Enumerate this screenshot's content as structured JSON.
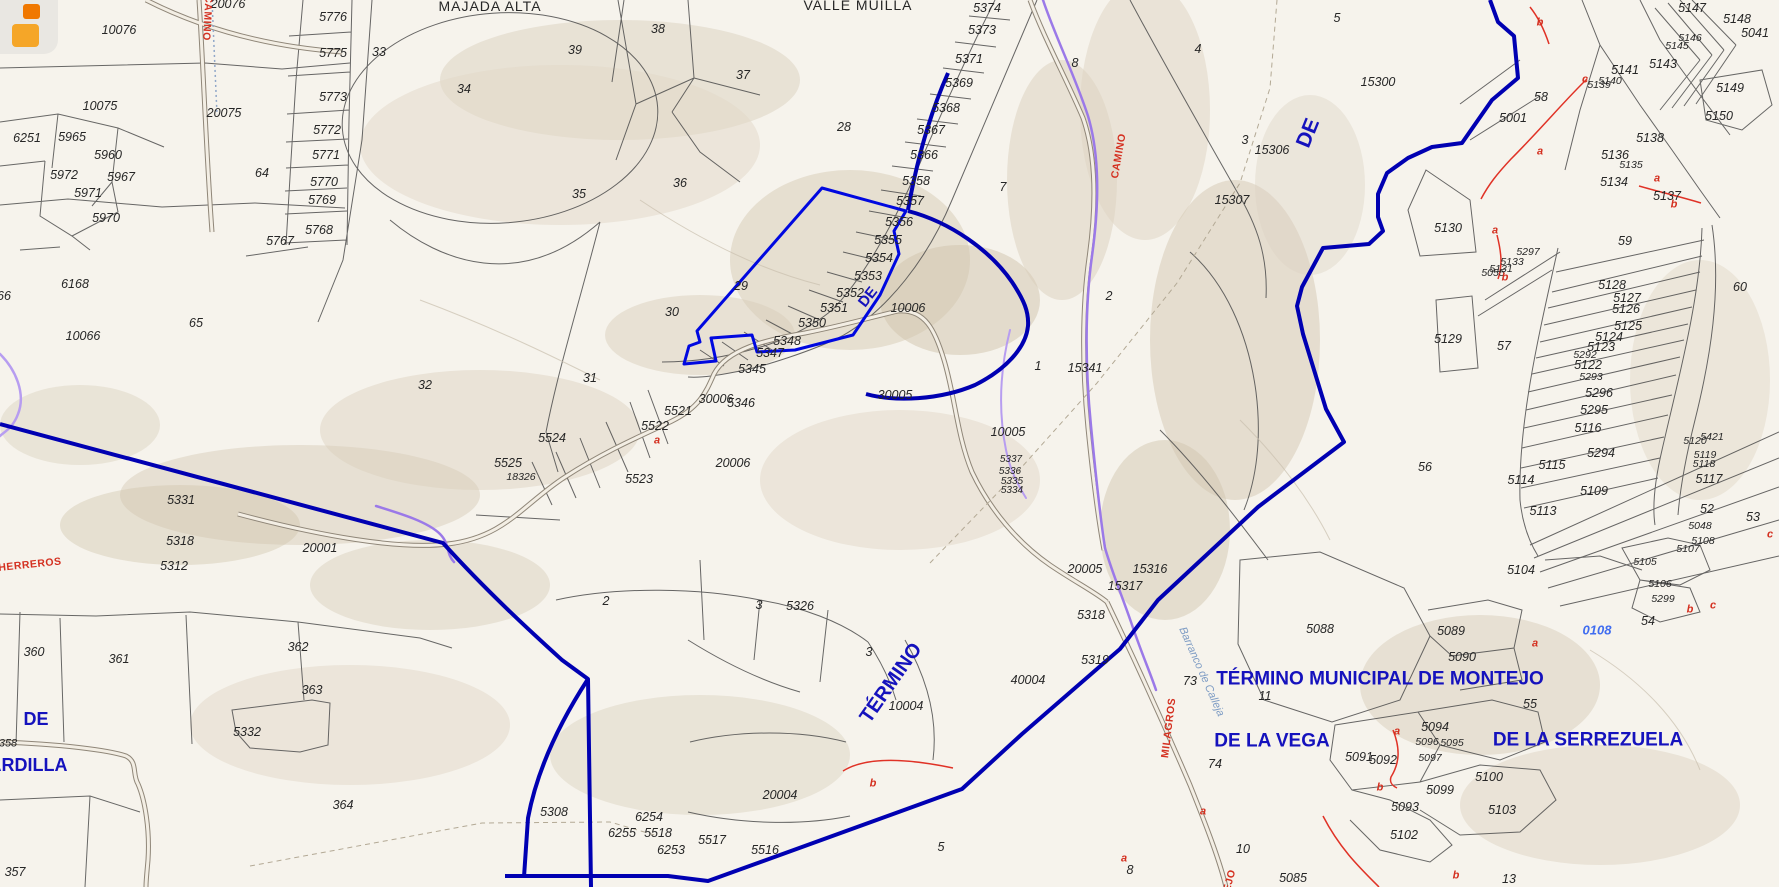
{
  "map": {
    "title_context": "cadastral parcel map",
    "colors": {
      "background": "#f6f3ec",
      "parcel_line": "#4d4d4d",
      "municipal_boundary_blue": "#0000b2",
      "highlight_parcel_blue": "#0008e0",
      "camino_purple": "#9b79e8",
      "red_annotation": "#d43020",
      "navy_label": "#1512bd",
      "light_blue_label": "#3f6cf0",
      "terrain_tan": "#d8cdb9"
    },
    "icon": {
      "name": "app-logo-icon",
      "shape": "two orange rounded squares"
    },
    "labels": [
      {
        "t": "10076",
        "x": 119,
        "y": 30
      },
      {
        "t": "20076",
        "x": 228,
        "y": 4
      },
      {
        "t": "10075",
        "x": 100,
        "y": 106
      },
      {
        "t": "20075",
        "x": 224,
        "y": 113
      },
      {
        "t": "5776",
        "x": 333,
        "y": 17
      },
      {
        "t": "5775",
        "x": 333,
        "y": 53
      },
      {
        "t": "5773",
        "x": 333,
        "y": 97
      },
      {
        "t": "5772",
        "x": 327,
        "y": 130
      },
      {
        "t": "5771",
        "x": 326,
        "y": 155
      },
      {
        "t": "5770",
        "x": 324,
        "y": 182
      },
      {
        "t": "5769",
        "x": 322,
        "y": 200
      },
      {
        "t": "5768",
        "x": 319,
        "y": 230
      },
      {
        "t": "5767",
        "x": 280,
        "y": 241
      },
      {
        "t": "33",
        "x": 379,
        "y": 52
      },
      {
        "t": "34",
        "x": 464,
        "y": 89
      },
      {
        "t": "39",
        "x": 575,
        "y": 50
      },
      {
        "t": "38",
        "x": 658,
        "y": 29
      },
      {
        "t": "37",
        "x": 743,
        "y": 75
      },
      {
        "t": "36",
        "x": 680,
        "y": 183
      },
      {
        "t": "35",
        "x": 579,
        "y": 194
      },
      {
        "t": "28",
        "x": 844,
        "y": 127
      },
      {
        "t": "29",
        "x": 741,
        "y": 286
      },
      {
        "t": "30",
        "x": 672,
        "y": 312
      },
      {
        "t": "31",
        "x": 590,
        "y": 378
      },
      {
        "t": "32",
        "x": 425,
        "y": 385
      },
      {
        "t": "64",
        "x": 262,
        "y": 173
      },
      {
        "t": "6251",
        "x": 27,
        "y": 138
      },
      {
        "t": "5965",
        "x": 72,
        "y": 137
      },
      {
        "t": "5960",
        "x": 108,
        "y": 155
      },
      {
        "t": "5972",
        "x": 64,
        "y": 175
      },
      {
        "t": "5967",
        "x": 121,
        "y": 177
      },
      {
        "t": "5971",
        "x": 88,
        "y": 193
      },
      {
        "t": "5970",
        "x": 106,
        "y": 218
      },
      {
        "t": "66",
        "x": 4,
        "y": 296
      },
      {
        "t": "6168",
        "x": 75,
        "y": 284
      },
      {
        "t": "10066",
        "x": 83,
        "y": 336
      },
      {
        "t": "65",
        "x": 196,
        "y": 323
      },
      {
        "t": "5374",
        "x": 987,
        "y": 8
      },
      {
        "t": "5373",
        "x": 982,
        "y": 30
      },
      {
        "t": "5371",
        "x": 969,
        "y": 59
      },
      {
        "t": "5369",
        "x": 959,
        "y": 83
      },
      {
        "t": "5368",
        "x": 946,
        "y": 108
      },
      {
        "t": "5367",
        "x": 931,
        "y": 130
      },
      {
        "t": "5366",
        "x": 924,
        "y": 155
      },
      {
        "t": "5358",
        "x": 916,
        "y": 181
      },
      {
        "t": "5357",
        "x": 910,
        "y": 201
      },
      {
        "t": "5356",
        "x": 899,
        "y": 222
      },
      {
        "t": "5355",
        "x": 888,
        "y": 240
      },
      {
        "t": "5354",
        "x": 879,
        "y": 258
      },
      {
        "t": "5353",
        "x": 868,
        "y": 276
      },
      {
        "t": "5352",
        "x": 850,
        "y": 293
      },
      {
        "t": "5351",
        "x": 834,
        "y": 308
      },
      {
        "t": "5350",
        "x": 812,
        "y": 323
      },
      {
        "t": "5348",
        "x": 787,
        "y": 341
      },
      {
        "t": "5347",
        "x": 770,
        "y": 353
      },
      {
        "t": "5345",
        "x": 752,
        "y": 369
      },
      {
        "t": "5346",
        "x": 741,
        "y": 403
      },
      {
        "t": "7",
        "x": 1003,
        "y": 187
      },
      {
        "t": "8",
        "x": 1075,
        "y": 63
      },
      {
        "t": "10006",
        "x": 908,
        "y": 308
      },
      {
        "t": "30005",
        "x": 895,
        "y": 395
      },
      {
        "t": "30006",
        "x": 716,
        "y": 399
      },
      {
        "t": "20006",
        "x": 733,
        "y": 463
      },
      {
        "t": "5521",
        "x": 678,
        "y": 411
      },
      {
        "t": "5522",
        "x": 655,
        "y": 426
      },
      {
        "t": "5523",
        "x": 639,
        "y": 479
      },
      {
        "t": "5524",
        "x": 552,
        "y": 438
      },
      {
        "t": "5525",
        "x": 508,
        "y": 463
      },
      {
        "t": "18326",
        "x": 521,
        "y": 477,
        "s": 10.5
      },
      {
        "t": "5331",
        "x": 181,
        "y": 500
      },
      {
        "t": "5318",
        "x": 180,
        "y": 541
      },
      {
        "t": "5312",
        "x": 174,
        "y": 566
      },
      {
        "t": "20001",
        "x": 320,
        "y": 548
      },
      {
        "t": "2",
        "x": 606,
        "y": 601
      },
      {
        "t": "3",
        "x": 759,
        "y": 605
      },
      {
        "t": "5326",
        "x": 800,
        "y": 606
      },
      {
        "t": "3",
        "x": 869,
        "y": 652
      },
      {
        "t": "2",
        "x": 1109,
        "y": 296
      },
      {
        "t": "1",
        "x": 1038,
        "y": 366
      },
      {
        "t": "15341",
        "x": 1085,
        "y": 368
      },
      {
        "t": "10005",
        "x": 1008,
        "y": 432
      },
      {
        "t": "5337",
        "x": 1011,
        "y": 460,
        "s": 10
      },
      {
        "t": "5336",
        "x": 1010,
        "y": 472,
        "s": 10
      },
      {
        "t": "5335",
        "x": 1012,
        "y": 482,
        "s": 10
      },
      {
        "t": "5334",
        "x": 1012,
        "y": 491,
        "s": 10
      },
      {
        "t": "20005",
        "x": 1085,
        "y": 569
      },
      {
        "t": "15316",
        "x": 1150,
        "y": 569
      },
      {
        "t": "15317",
        "x": 1125,
        "y": 586
      },
      {
        "t": "5318",
        "x": 1091,
        "y": 615
      },
      {
        "t": "5319",
        "x": 1095,
        "y": 660
      },
      {
        "t": "40004",
        "x": 1028,
        "y": 680
      },
      {
        "t": "10004",
        "x": 906,
        "y": 706
      },
      {
        "t": "20004",
        "x": 780,
        "y": 795
      },
      {
        "t": "73",
        "x": 1190,
        "y": 681
      },
      {
        "t": "11",
        "x": 1265,
        "y": 696
      },
      {
        "t": "74",
        "x": 1215,
        "y": 764
      },
      {
        "t": "10",
        "x": 1243,
        "y": 849
      },
      {
        "t": "8",
        "x": 1130,
        "y": 870
      },
      {
        "t": "5085",
        "x": 1293,
        "y": 878
      },
      {
        "t": "13",
        "x": 1509,
        "y": 879
      },
      {
        "t": "5",
        "x": 941,
        "y": 847
      },
      {
        "t": "364",
        "x": 343,
        "y": 805
      },
      {
        "t": "5332",
        "x": 247,
        "y": 732
      },
      {
        "t": "5308",
        "x": 554,
        "y": 812
      },
      {
        "t": "6254",
        "x": 649,
        "y": 817
      },
      {
        "t": "6255",
        "x": 622,
        "y": 833
      },
      {
        "t": "5518",
        "x": 658,
        "y": 833
      },
      {
        "t": "6253",
        "x": 671,
        "y": 850
      },
      {
        "t": "5517",
        "x": 712,
        "y": 840
      },
      {
        "t": "5516",
        "x": 765,
        "y": 850
      },
      {
        "t": "360",
        "x": 34,
        "y": 652
      },
      {
        "t": "361",
        "x": 119,
        "y": 659
      },
      {
        "t": "362",
        "x": 298,
        "y": 647
      },
      {
        "t": "363",
        "x": 312,
        "y": 690
      },
      {
        "t": "358",
        "x": 8,
        "y": 744,
        "s": 11
      },
      {
        "t": "357",
        "x": 15,
        "y": 872
      },
      {
        "t": "5088",
        "x": 1320,
        "y": 629
      },
      {
        "t": "5089",
        "x": 1451,
        "y": 631
      },
      {
        "t": "5090",
        "x": 1462,
        "y": 657
      },
      {
        "t": "5091",
        "x": 1359,
        "y": 757
      },
      {
        "t": "5092",
        "x": 1383,
        "y": 760
      },
      {
        "t": "5094",
        "x": 1435,
        "y": 727
      },
      {
        "t": "5096",
        "x": 1427,
        "y": 742,
        "s": 10.5
      },
      {
        "t": "5095",
        "x": 1452,
        "y": 743,
        "s": 10.5
      },
      {
        "t": "5097",
        "x": 1430,
        "y": 758,
        "s": 10.5
      },
      {
        "t": "5099",
        "x": 1440,
        "y": 790
      },
      {
        "t": "5100",
        "x": 1489,
        "y": 777
      },
      {
        "t": "5093",
        "x": 1405,
        "y": 807
      },
      {
        "t": "5103",
        "x": 1502,
        "y": 810
      },
      {
        "t": "5102",
        "x": 1404,
        "y": 835
      },
      {
        "t": "55",
        "x": 1530,
        "y": 704
      },
      {
        "t": "54",
        "x": 1648,
        "y": 621
      },
      {
        "t": "5104",
        "x": 1521,
        "y": 570
      },
      {
        "t": "4",
        "x": 1198,
        "y": 49
      },
      {
        "t": "5",
        "x": 1337,
        "y": 18
      },
      {
        "t": "15300",
        "x": 1378,
        "y": 82
      },
      {
        "t": "3",
        "x": 1245,
        "y": 140
      },
      {
        "t": "15306",
        "x": 1272,
        "y": 150
      },
      {
        "t": "15307",
        "x": 1232,
        "y": 200
      },
      {
        "t": "5130",
        "x": 1448,
        "y": 228
      },
      {
        "t": "5129",
        "x": 1448,
        "y": 339
      },
      {
        "t": "57",
        "x": 1504,
        "y": 346
      },
      {
        "t": "56",
        "x": 1425,
        "y": 467
      },
      {
        "t": "59",
        "x": 1625,
        "y": 241
      },
      {
        "t": "60",
        "x": 1740,
        "y": 287
      },
      {
        "t": "58",
        "x": 1541,
        "y": 97
      },
      {
        "t": "5001",
        "x": 1513,
        "y": 118
      },
      {
        "t": "5128",
        "x": 1612,
        "y": 285
      },
      {
        "t": "5127",
        "x": 1627,
        "y": 298
      },
      {
        "t": "5126",
        "x": 1626,
        "y": 309
      },
      {
        "t": "5125",
        "x": 1628,
        "y": 326
      },
      {
        "t": "5124",
        "x": 1609,
        "y": 337
      },
      {
        "t": "5123",
        "x": 1601,
        "y": 347
      },
      {
        "t": "5292",
        "x": 1585,
        "y": 355,
        "s": 10.5
      },
      {
        "t": "5122",
        "x": 1588,
        "y": 365
      },
      {
        "t": "5293",
        "x": 1591,
        "y": 377,
        "s": 10.5
      },
      {
        "t": "5296",
        "x": 1599,
        "y": 393
      },
      {
        "t": "5295",
        "x": 1594,
        "y": 410
      },
      {
        "t": "5116",
        "x": 1588,
        "y": 428
      },
      {
        "t": "5294",
        "x": 1601,
        "y": 453
      },
      {
        "t": "5115",
        "x": 1552,
        "y": 465
      },
      {
        "t": "5114",
        "x": 1521,
        "y": 480
      },
      {
        "t": "5109",
        "x": 1594,
        "y": 491
      },
      {
        "t": "5113",
        "x": 1543,
        "y": 511
      },
      {
        "t": "5120",
        "x": 1695,
        "y": 441,
        "s": 10.5
      },
      {
        "t": "5421",
        "x": 1712,
        "y": 437,
        "s": 10.5
      },
      {
        "t": "5119",
        "x": 1705,
        "y": 455,
        "s": 10.5
      },
      {
        "t": "5118",
        "x": 1704,
        "y": 464,
        "s": 10.5
      },
      {
        "t": "5117",
        "x": 1709,
        "y": 479
      },
      {
        "t": "52",
        "x": 1707,
        "y": 509
      },
      {
        "t": "5048",
        "x": 1700,
        "y": 526,
        "s": 10.5
      },
      {
        "t": "5108",
        "x": 1703,
        "y": 541,
        "s": 10.5
      },
      {
        "t": "53",
        "x": 1753,
        "y": 517
      },
      {
        "t": "5107",
        "x": 1688,
        "y": 549,
        "s": 10.5
      },
      {
        "t": "5105",
        "x": 1645,
        "y": 562,
        "s": 10.5
      },
      {
        "t": "5106",
        "x": 1660,
        "y": 584,
        "s": 10.5
      },
      {
        "t": "5299",
        "x": 1663,
        "y": 599,
        "s": 10.5
      },
      {
        "t": "5147",
        "x": 1692,
        "y": 8
      },
      {
        "t": "5148",
        "x": 1737,
        "y": 19
      },
      {
        "t": "5041",
        "x": 1755,
        "y": 33
      },
      {
        "t": "5146",
        "x": 1690,
        "y": 38,
        "s": 10.5
      },
      {
        "t": "5145",
        "x": 1677,
        "y": 46,
        "s": 10.5
      },
      {
        "t": "5143",
        "x": 1663,
        "y": 64
      },
      {
        "t": "5141",
        "x": 1625,
        "y": 70
      },
      {
        "t": "5140",
        "x": 1610,
        "y": 81,
        "s": 10.5
      },
      {
        "t": "5139",
        "x": 1599,
        "y": 85,
        "s": 10.5
      },
      {
        "t": "5149",
        "x": 1730,
        "y": 88
      },
      {
        "t": "5150",
        "x": 1719,
        "y": 116
      },
      {
        "t": "5138",
        "x": 1650,
        "y": 138
      },
      {
        "t": "5136",
        "x": 1615,
        "y": 155
      },
      {
        "t": "5135",
        "x": 1631,
        "y": 165,
        "s": 10.5
      },
      {
        "t": "5134",
        "x": 1614,
        "y": 182
      },
      {
        "t": "5137",
        "x": 1667,
        "y": 196
      },
      {
        "t": "5297",
        "x": 1528,
        "y": 252,
        "s": 10.5
      },
      {
        "t": "5133",
        "x": 1512,
        "y": 262,
        "s": 10.5
      },
      {
        "t": "5131",
        "x": 1501,
        "y": 269,
        "s": 10.5
      },
      {
        "t": "5055",
        "x": 1493,
        "y": 273,
        "s": 10.5
      },
      {
        "t": "a",
        "x": 657,
        "y": 441,
        "c": "r"
      },
      {
        "t": "b",
        "x": 873,
        "y": 784,
        "c": "r"
      },
      {
        "t": "a",
        "x": 1124,
        "y": 859,
        "c": "r"
      },
      {
        "t": "a",
        "x": 1203,
        "y": 812,
        "c": "r"
      },
      {
        "t": "b",
        "x": 1456,
        "y": 876,
        "c": "r"
      },
      {
        "t": "b",
        "x": 1380,
        "y": 788,
        "c": "r"
      },
      {
        "t": "a",
        "x": 1397,
        "y": 732,
        "c": "r"
      },
      {
        "t": "a",
        "x": 1535,
        "y": 644,
        "c": "r"
      },
      {
        "t": "a",
        "x": 1495,
        "y": 231,
        "c": "r"
      },
      {
        "t": "b",
        "x": 1505,
        "y": 278,
        "c": "r"
      },
      {
        "t": "b",
        "x": 1540,
        "y": 23,
        "c": "r"
      },
      {
        "t": "c",
        "x": 1585,
        "y": 80,
        "c": "r"
      },
      {
        "t": "a",
        "x": 1540,
        "y": 152,
        "c": "r"
      },
      {
        "t": "a",
        "x": 1657,
        "y": 179,
        "c": "r"
      },
      {
        "t": "b",
        "x": 1674,
        "y": 205,
        "c": "r"
      },
      {
        "t": "b",
        "x": 1690,
        "y": 610,
        "c": "r"
      },
      {
        "t": "c",
        "x": 1713,
        "y": 606,
        "c": "r"
      },
      {
        "t": "c",
        "x": 1770,
        "y": 535,
        "c": "r"
      },
      {
        "t": "CAMINO",
        "x": 207,
        "y": 18,
        "c": "rr",
        "r": 93
      },
      {
        "t": "CAMINO",
        "x": 1119,
        "y": 156,
        "c": "rr",
        "r": -80
      },
      {
        "t": "HERREROS",
        "x": 30,
        "y": 565,
        "c": "rr",
        "r": -6
      },
      {
        "t": "MILAGROS",
        "x": 1169,
        "y": 728,
        "c": "rr",
        "r": -83
      },
      {
        "t": "TEJO",
        "x": 1229,
        "y": 884,
        "c": "rr",
        "r": -75
      },
      {
        "t": "Barranco de Calleja",
        "x": 1201,
        "y": 672,
        "c": "st",
        "r": 66
      },
      {
        "t": "DE",
        "x": 868,
        "y": 297,
        "c": "nv",
        "r": -52,
        "s": 15
      },
      {
        "t": "DE",
        "x": 1308,
        "y": 133,
        "c": "nv",
        "r": -68,
        "s": 21
      },
      {
        "t": "TÉRMINO",
        "x": 891,
        "y": 683,
        "c": "nv",
        "r": -55,
        "s": 20
      },
      {
        "t": "DE",
        "x": 36,
        "y": 719,
        "c": "nv",
        "s": 18
      },
      {
        "t": "ARDILLA",
        "x": 28,
        "y": 765,
        "c": "nv",
        "s": 18
      },
      {
        "t": "TÉRMINO MUNICIPAL DE MONTEJO",
        "x": 1380,
        "y": 679,
        "c": "nv",
        "s": 19
      },
      {
        "t": "DE LA VEGA",
        "x": 1272,
        "y": 741,
        "c": "nv",
        "s": 19
      },
      {
        "t": "DE LA SERREZUELA",
        "x": 1588,
        "y": 740,
        "c": "nv",
        "s": 19
      },
      {
        "t": "0108",
        "x": 1597,
        "y": 630,
        "c": "lb"
      },
      {
        "t": "MAJADA ALTA",
        "x": 490,
        "y": 6,
        "c": "nm"
      },
      {
        "t": "VALLE MUILLA",
        "x": 858,
        "y": 5,
        "c": "nm"
      }
    ]
  }
}
